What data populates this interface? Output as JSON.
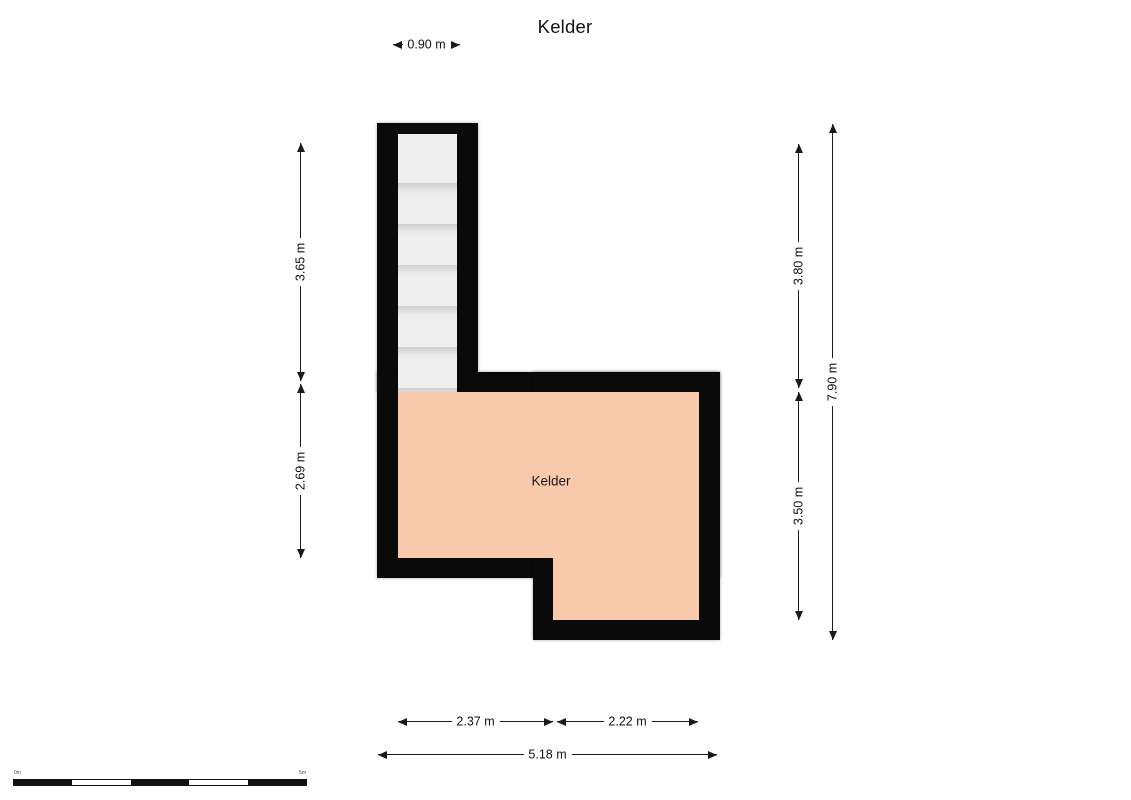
{
  "title": "Kelder",
  "room": {
    "label": "Kelder"
  },
  "stairs": {
    "tread_count": 6
  },
  "dimensions": {
    "top_width": "0.90 m",
    "left_upper": "3.65 m",
    "left_lower": "2.69 m",
    "right_upper": "3.80 m",
    "right_lower": "3.50 m",
    "right_total": "7.90 m",
    "bottom_left": "2.37 m",
    "bottom_right": "2.22 m",
    "bottom_total": "5.18 m"
  },
  "scalebar": {
    "start_label": "0m",
    "end_label": "5m"
  },
  "colors": {
    "wall": "#0a0a0a",
    "room_fill": "#f8c9ab",
    "stair_fill": "#efefef",
    "dim": "#1a1a1a"
  }
}
